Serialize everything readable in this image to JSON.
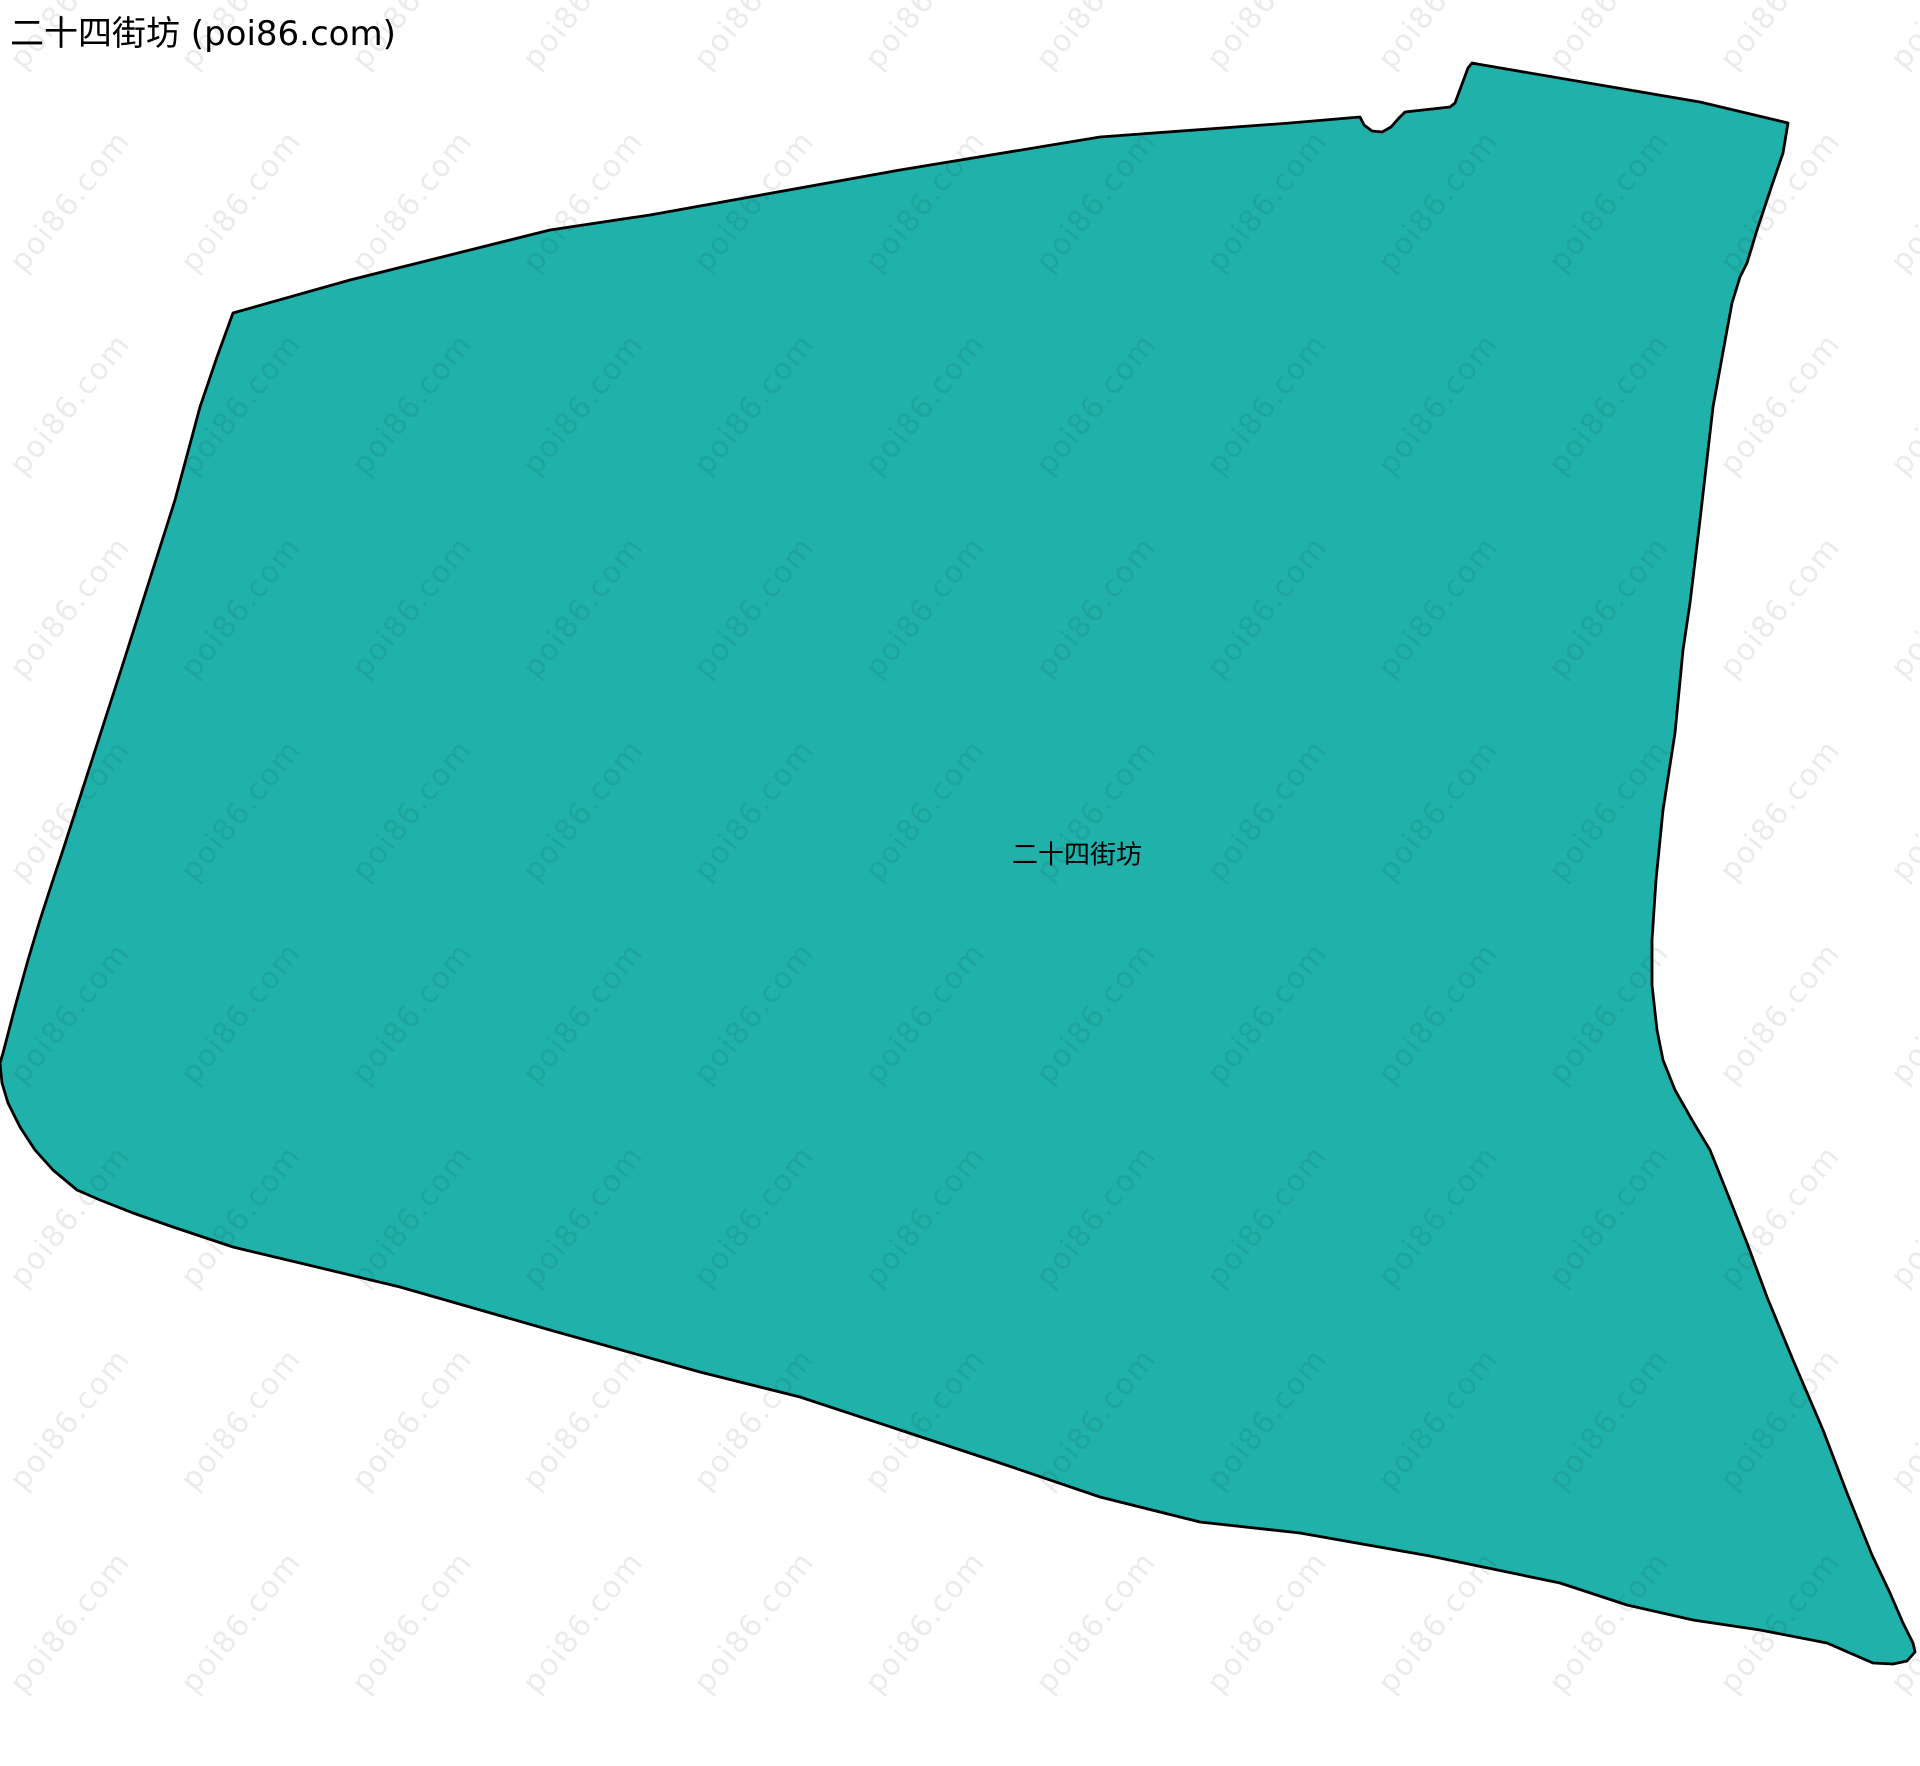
{
  "page": {
    "title": "二十四街坊 (poi86.com)",
    "background_color": "#ffffff"
  },
  "map": {
    "region_name": "二十四街坊",
    "fill_color": "#20b2aa",
    "stroke_color": "#000000",
    "stroke_width": 2.8,
    "polygon_points": [
      [
        233,
        313
      ],
      [
        350,
        280
      ],
      [
        450,
        255
      ],
      [
        550,
        230
      ],
      [
        650,
        215
      ],
      [
        900,
        170
      ],
      [
        1100,
        137
      ],
      [
        1290,
        123
      ],
      [
        1360,
        117
      ],
      [
        1364,
        125
      ],
      [
        1372,
        131
      ],
      [
        1382,
        132
      ],
      [
        1391,
        127
      ],
      [
        1398,
        119
      ],
      [
        1405,
        112
      ],
      [
        1450,
        107
      ],
      [
        1455,
        103
      ],
      [
        1468,
        68
      ],
      [
        1472,
        63
      ],
      [
        1483,
        65
      ],
      [
        1600,
        85
      ],
      [
        1700,
        102
      ],
      [
        1788,
        123
      ],
      [
        1783,
        153
      ],
      [
        1772,
        185
      ],
      [
        1757,
        230
      ],
      [
        1747,
        263
      ],
      [
        1740,
        277
      ],
      [
        1732,
        303
      ],
      [
        1727,
        330
      ],
      [
        1713,
        407
      ],
      [
        1700,
        520
      ],
      [
        1690,
        603
      ],
      [
        1683,
        650
      ],
      [
        1675,
        733
      ],
      [
        1663,
        810
      ],
      [
        1656,
        880
      ],
      [
        1652,
        940
      ],
      [
        1652,
        985
      ],
      [
        1657,
        1030
      ],
      [
        1663,
        1060
      ],
      [
        1675,
        1090
      ],
      [
        1692,
        1120
      ],
      [
        1710,
        1150
      ],
      [
        1730,
        1200
      ],
      [
        1747,
        1243
      ],
      [
        1767,
        1297
      ],
      [
        1793,
        1360
      ],
      [
        1823,
        1430
      ],
      [
        1847,
        1493
      ],
      [
        1872,
        1555
      ],
      [
        1890,
        1593
      ],
      [
        1903,
        1623
      ],
      [
        1913,
        1643
      ],
      [
        1915,
        1652
      ],
      [
        1907,
        1661
      ],
      [
        1893,
        1664
      ],
      [
        1873,
        1663
      ],
      [
        1827,
        1643
      ],
      [
        1760,
        1630
      ],
      [
        1693,
        1620
      ],
      [
        1627,
        1605
      ],
      [
        1560,
        1583
      ],
      [
        1430,
        1556
      ],
      [
        1300,
        1533
      ],
      [
        1200,
        1522
      ],
      [
        1100,
        1497
      ],
      [
        1000,
        1463
      ],
      [
        900,
        1430
      ],
      [
        800,
        1397
      ],
      [
        700,
        1372
      ],
      [
        550,
        1330
      ],
      [
        400,
        1287
      ],
      [
        300,
        1263
      ],
      [
        233,
        1247
      ],
      [
        173,
        1227
      ],
      [
        133,
        1213
      ],
      [
        100,
        1200
      ],
      [
        77,
        1190
      ],
      [
        53,
        1170
      ],
      [
        35,
        1150
      ],
      [
        20,
        1127
      ],
      [
        8,
        1103
      ],
      [
        2,
        1083
      ],
      [
        0,
        1063
      ],
      [
        3,
        1053
      ],
      [
        15,
        1007
      ],
      [
        28,
        960
      ],
      [
        40,
        920
      ],
      [
        52,
        883
      ],
      [
        63,
        850
      ],
      [
        121,
        670
      ],
      [
        175,
        500
      ],
      [
        200,
        407
      ],
      [
        217,
        357
      ]
    ]
  },
  "watermark": {
    "text": "poi86.com",
    "color": "rgba(0,0,0,0.08)"
  }
}
